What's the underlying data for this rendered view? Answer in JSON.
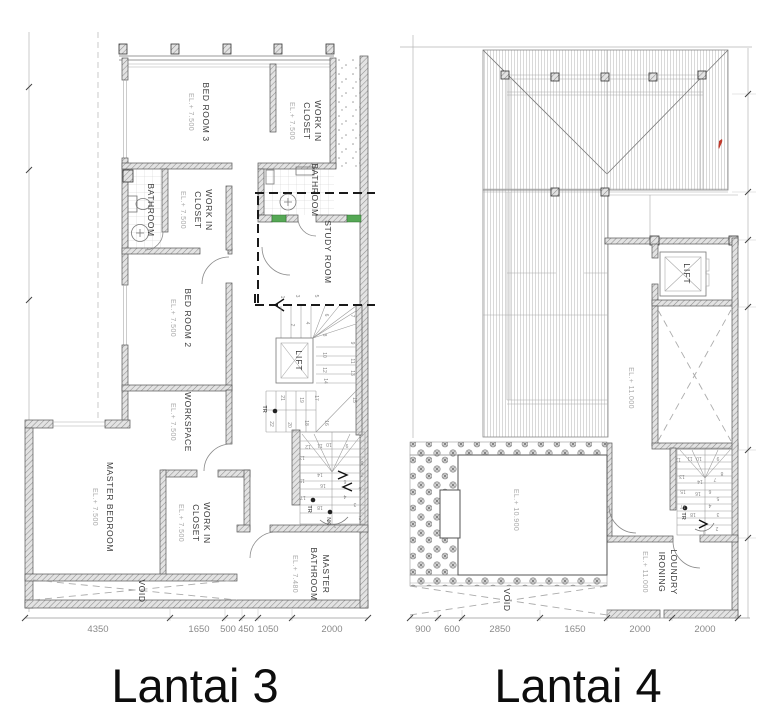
{
  "titles": {
    "left": "Lantai 3",
    "right": "Lantai 4"
  },
  "plan3": {
    "rooms": {
      "bedroom3": {
        "name": "BED ROOM 3",
        "el": "EL.+ 7.500"
      },
      "closet_top": {
        "name1": "WORK IN",
        "name2": "CLOSET",
        "el": "EL.+ 7.500"
      },
      "bathroom_left": {
        "name": "BATHROOM"
      },
      "closet_mid": {
        "name1": "WORK IN",
        "name2": "CLOSET",
        "el": "EL.+ 7.500"
      },
      "bathroom_top": {
        "name": "BATHROOM"
      },
      "study": {
        "name": "STUDY ROOM"
      },
      "bedroom2": {
        "name": "BED ROOM 2",
        "el": "EL.+ 7.500"
      },
      "workspace": {
        "name": "WORKSPACE",
        "el": "EL.+ 7.500"
      },
      "lift": {
        "name": "LIFT"
      },
      "master_bedroom": {
        "name": "MASTER BEDROOM",
        "el": "EL.+ 7.500"
      },
      "master_closet": {
        "name1": "WORK IN",
        "name2": "CLOSET",
        "el": "EL.+ 7.500"
      },
      "master_bathroom": {
        "name1": "MASTER",
        "name2": "BATHROOM",
        "el": "EL.+ 7.480"
      },
      "void": {
        "name": "VOID"
      }
    },
    "stair_up": {
      "numbers": [
        "1",
        "2",
        "3",
        "4",
        "5",
        "6",
        "7",
        "8",
        "9",
        "10",
        "11",
        "12",
        "13",
        "14",
        "15",
        "16",
        "17",
        "18",
        "19",
        "20",
        "21",
        "22"
      ],
      "tr": "TR"
    },
    "stair_down": {
      "numbers": [
        "1",
        "2",
        "3",
        "4",
        "5",
        "6",
        "7",
        "8",
        "9",
        "10",
        "11",
        "12",
        "13",
        "14",
        "15",
        "16",
        "17",
        "18"
      ],
      "tr": "TR",
      "nk": "NK"
    },
    "dimensions": [
      "4350",
      "1650",
      "500",
      "450",
      "1050",
      "2000"
    ]
  },
  "plan4": {
    "rooms": {
      "lift": {
        "name": "LIFT"
      },
      "hall": {
        "el": "EL.+ 11.000"
      },
      "roof_terrace": {
        "el": "EL.+ 10.900"
      },
      "void": {
        "name": "VOID"
      },
      "loundry": {
        "name1": "LOUNDRY",
        "name2": "IRONING",
        "el": "EL.+ 11.000"
      }
    },
    "stair": {
      "numbers": [
        "1",
        "2",
        "3",
        "4",
        "5",
        "6",
        "7",
        "8",
        "9",
        "10",
        "11",
        "12",
        "13",
        "14",
        "15",
        "16",
        "17",
        "18"
      ],
      "tr": "TR"
    },
    "dimensions": [
      "900",
      "600",
      "2850",
      "1650",
      "2000",
      "2000"
    ]
  },
  "colors": {
    "window_green": "#55a855",
    "roof_mark_red": "#c0392b"
  }
}
